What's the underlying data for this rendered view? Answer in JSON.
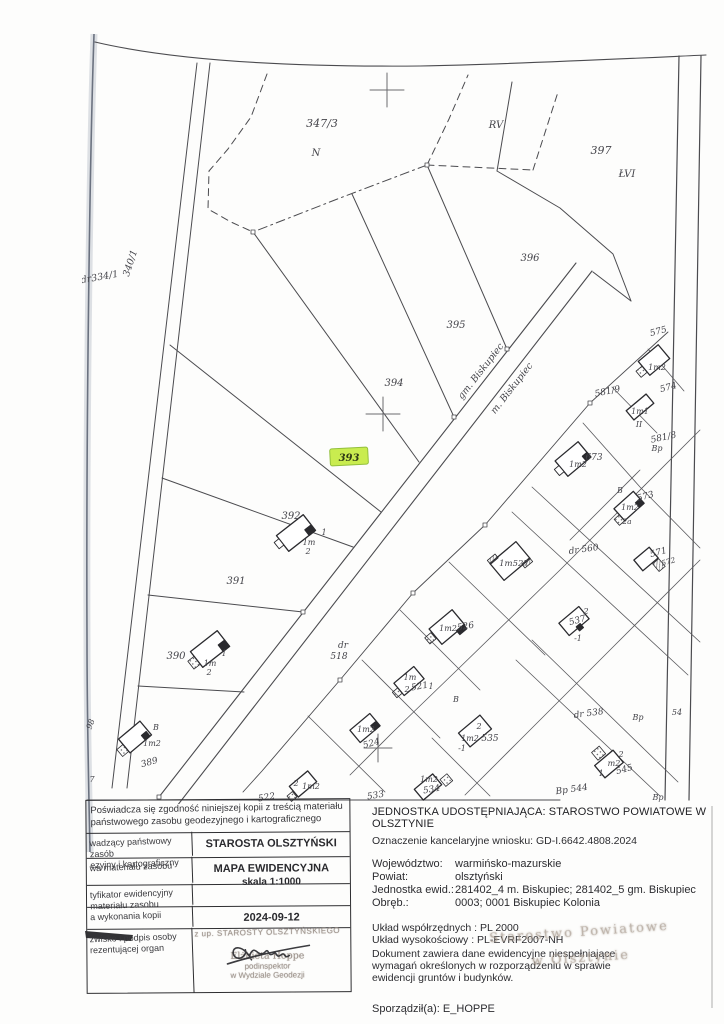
{
  "map": {
    "highlight_color": "#c9ec4f",
    "highlight_border": "#93c03c",
    "labels": [
      {
        "t": "347/3",
        "x": 322,
        "y": 127,
        "s": 11
      },
      {
        "t": "N",
        "x": 316,
        "y": 156,
        "s": 10
      },
      {
        "t": "RV",
        "x": 496,
        "y": 128,
        "s": 10
      },
      {
        "t": "397",
        "x": 601,
        "y": 154,
        "s": 11
      },
      {
        "t": "ŁVI",
        "x": 627,
        "y": 177,
        "s": 10
      },
      {
        "t": "396",
        "x": 530,
        "y": 261,
        "s": 10
      },
      {
        "t": "395",
        "x": 456,
        "y": 328,
        "s": 10
      },
      {
        "t": "394",
        "x": 394,
        "y": 386,
        "s": 10
      },
      {
        "t": "393",
        "x": 349,
        "y": 461,
        "s": 10,
        "cls": "hl"
      },
      {
        "t": "gm. Biskupiec",
        "x": 483,
        "y": 373,
        "r": -52,
        "s": 9.5
      },
      {
        "t": "m. Biskupiec",
        "x": 514,
        "y": 390,
        "r": -52,
        "s": 9.5
      },
      {
        "t": "392",
        "x": 291,
        "y": 519,
        "s": 10
      },
      {
        "t": "1",
        "x": 324,
        "y": 535,
        "s": 8
      },
      {
        "t": "1m",
        "x": 309,
        "y": 545,
        "s": 8
      },
      {
        "t": "2",
        "x": 308,
        "y": 554,
        "s": 8
      },
      {
        "t": "391",
        "x": 236,
        "y": 584,
        "s": 10
      },
      {
        "t": "390",
        "x": 176,
        "y": 659,
        "s": 10
      },
      {
        "t": "1",
        "x": 224,
        "y": 656,
        "s": 8
      },
      {
        "t": "1m",
        "x": 210,
        "y": 666,
        "s": 8
      },
      {
        "t": "2",
        "x": 209,
        "y": 675,
        "s": 8
      },
      {
        "t": "340/1",
        "x": 133,
        "y": 264,
        "r": -72,
        "s": 9.5
      },
      {
        "t": "dr334/1",
        "x": 100,
        "y": 280,
        "r": -10,
        "s": 9.5
      },
      {
        "t": "98",
        "x": 93,
        "y": 725,
        "r": -70,
        "s": 8
      },
      {
        "t": "7",
        "x": 92,
        "y": 782,
        "s": 8
      },
      {
        "t": "B",
        "x": 156,
        "y": 730,
        "s": 8
      },
      {
        "t": "1m2",
        "x": 152,
        "y": 746,
        "s": 8
      },
      {
        "t": "389",
        "x": 150,
        "y": 765,
        "r": -15,
        "s": 9
      },
      {
        "t": "dr",
        "x": 343,
        "y": 648,
        "s": 9
      },
      {
        "t": "518",
        "x": 339,
        "y": 659,
        "s": 9
      },
      {
        "t": "575",
        "x": 659,
        "y": 334,
        "r": -15,
        "s": 9
      },
      {
        "t": "1m2",
        "x": 657,
        "y": 370,
        "s": 8
      },
      {
        "t": "574",
        "x": 669,
        "y": 390,
        "r": -15,
        "s": 9
      },
      {
        "t": "581/9",
        "x": 608,
        "y": 394,
        "r": -12,
        "s": 9
      },
      {
        "t": "1m1",
        "x": 640,
        "y": 414,
        "s": 8
      },
      {
        "t": "II",
        "x": 639,
        "y": 427,
        "s": 8
      },
      {
        "t": "581/8",
        "x": 664,
        "y": 440,
        "r": -12,
        "s": 9
      },
      {
        "t": "Bp",
        "x": 657,
        "y": 451,
        "s": 8
      },
      {
        "t": "673",
        "x": 594,
        "y": 460,
        "s": 9
      },
      {
        "t": "1m2",
        "x": 578,
        "y": 467,
        "s": 8
      },
      {
        "t": "B",
        "x": 620,
        "y": 493,
        "s": 8
      },
      {
        "t": "573",
        "x": 646,
        "y": 499,
        "r": -15,
        "s": 9
      },
      {
        "t": "1m2",
        "x": 630,
        "y": 510,
        "s": 8
      },
      {
        "t": "2a",
        "x": 627,
        "y": 524,
        "s": 7.5
      },
      {
        "t": "dr 560",
        "x": 584,
        "y": 552,
        "r": -8,
        "s": 9
      },
      {
        "t": "571",
        "x": 659,
        "y": 555,
        "r": -15,
        "s": 9
      },
      {
        "t": "572",
        "x": 669,
        "y": 564,
        "r": -15,
        "s": 7.5
      },
      {
        "t": "1m527",
        "x": 514,
        "y": 566,
        "s": 8.5
      },
      {
        "t": "2",
        "x": 586,
        "y": 614,
        "s": 8
      },
      {
        "t": "537",
        "x": 578,
        "y": 623,
        "r": -15,
        "s": 9
      },
      {
        "t": "-1",
        "x": 578,
        "y": 641,
        "s": 8
      },
      {
        "t": "526",
        "x": 466,
        "y": 629,
        "r": -10,
        "s": 9
      },
      {
        "t": "1m2",
        "x": 448,
        "y": 631,
        "s": 8
      },
      {
        "t": "B",
        "x": 456,
        "y": 702,
        "s": 8
      },
      {
        "t": "1m",
        "x": 410,
        "y": 680,
        "s": 8
      },
      {
        "t": "2",
        "x": 407,
        "y": 692,
        "s": 8
      },
      {
        "t": "521",
        "x": 420,
        "y": 689,
        "r": -10,
        "s": 9
      },
      {
        "t": "1",
        "x": 431,
        "y": 689,
        "s": 8
      },
      {
        "t": "1m2",
        "x": 366,
        "y": 732,
        "s": 8
      },
      {
        "t": "524",
        "x": 372,
        "y": 746,
        "r": -15,
        "s": 9
      },
      {
        "t": "2",
        "x": 479,
        "y": 729,
        "s": 8
      },
      {
        "t": "1m2",
        "x": 470,
        "y": 741,
        "s": 8
      },
      {
        "t": "535",
        "x": 490,
        "y": 741,
        "s": 9
      },
      {
        "t": "-1",
        "x": 462,
        "y": 751,
        "s": 8
      },
      {
        "t": "2",
        "x": 296,
        "y": 786,
        "s": 8
      },
      {
        "t": "1m2",
        "x": 311,
        "y": 789,
        "s": 8
      },
      {
        "t": "522",
        "x": 267,
        "y": 800,
        "r": -10,
        "s": 9
      },
      {
        "t": "533",
        "x": 376,
        "y": 798,
        "r": -10,
        "s": 9
      },
      {
        "t": "1m2",
        "x": 429,
        "y": 782,
        "s": 8
      },
      {
        "t": "534",
        "x": 432,
        "y": 792,
        "r": -10,
        "s": 9
      },
      {
        "t": "dr 538",
        "x": 589,
        "y": 716,
        "r": -8,
        "s": 9
      },
      {
        "t": "Bp",
        "x": 638,
        "y": 720,
        "s": 8
      },
      {
        "t": "54",
        "x": 677,
        "y": 715,
        "s": 8
      },
      {
        "t": "2",
        "x": 621,
        "y": 757,
        "s": 8
      },
      {
        "t": "m2",
        "x": 614,
        "y": 766,
        "s": 8
      },
      {
        "t": "1",
        "x": 601,
        "y": 776,
        "s": 8
      },
      {
        "t": "545",
        "x": 625,
        "y": 772,
        "r": -15,
        "s": 9
      },
      {
        "t": "Bp 544",
        "x": 572,
        "y": 792,
        "r": -8,
        "s": 9
      },
      {
        "t": "Bp",
        "x": 658,
        "y": 800,
        "s": 8
      }
    ]
  },
  "table": {
    "header": [
      "Poświadcza się zgodność niniejszej kopii z treścią materiału",
      "państwowego zasobu geodezyjnego i kartograficznego"
    ],
    "rows": [
      {
        "label": [
          "wadzący państwowy zasób",
          "ezyjny i kartograficzny"
        ],
        "value": [
          "STAROSTA  OLSZTYŃSKI"
        ]
      },
      {
        "label": [
          "wa materiału zasobu"
        ],
        "value": [
          "MAPA  EWIDENCYJNA",
          "skala 1:1000"
        ]
      },
      {
        "label": [
          "tyfikator ewidencyjny",
          "materiału zasobu"
        ],
        "value": []
      },
      {
        "label": [
          "a wykonania kopii"
        ],
        "value": [
          "2024-09-12"
        ]
      },
      {
        "label": [
          "zwisko i podpis osoby",
          "rezentującej organ"
        ],
        "value": []
      }
    ],
    "stamp": {
      "line1": "z up. STAROSTY OLSZTYŃSKIEGO",
      "name": "Elżbieta Hoppe",
      "title": "podinspektor",
      "dept": "w Wydziale Geodezji"
    }
  },
  "info": {
    "provider": "JEDNOSTKA UDOSTĘPNIAJĄCA: STAROSTWO POWIATOWE W OLSZTYNIE",
    "case_ref": "Oznaczenie kancelaryjne wniosku: GD-I.6642.4808.2024",
    "fields": [
      {
        "label": "Województwo:",
        "value": "warmińsko-mazurskie"
      },
      {
        "label": "Powiat:",
        "value": "olsztyński"
      },
      {
        "label": "Jednostka ewid.:",
        "value": "281402_4 m. Biskupiec; 281402_5 gm. Biskupiec"
      },
      {
        "label": "Obręb.:",
        "value": "0003; 0001 Biskupiec Kolonia"
      }
    ],
    "crs": [
      "Układ współrzędnych : PL 2000",
      "Układ wysokościowy : PL-EVRF2007-NH"
    ],
    "note": [
      "Dokument zawiera dane ewidencyjne niespełniające",
      "wymagań określonych w rozporządzeniu w sprawie",
      "ewidencji gruntów i budynków."
    ],
    "prepared_by": "Sporządził(a): E_HOPPE",
    "watermark": [
      "Starostwo Powiatowe",
      "w Olsztynie"
    ]
  }
}
